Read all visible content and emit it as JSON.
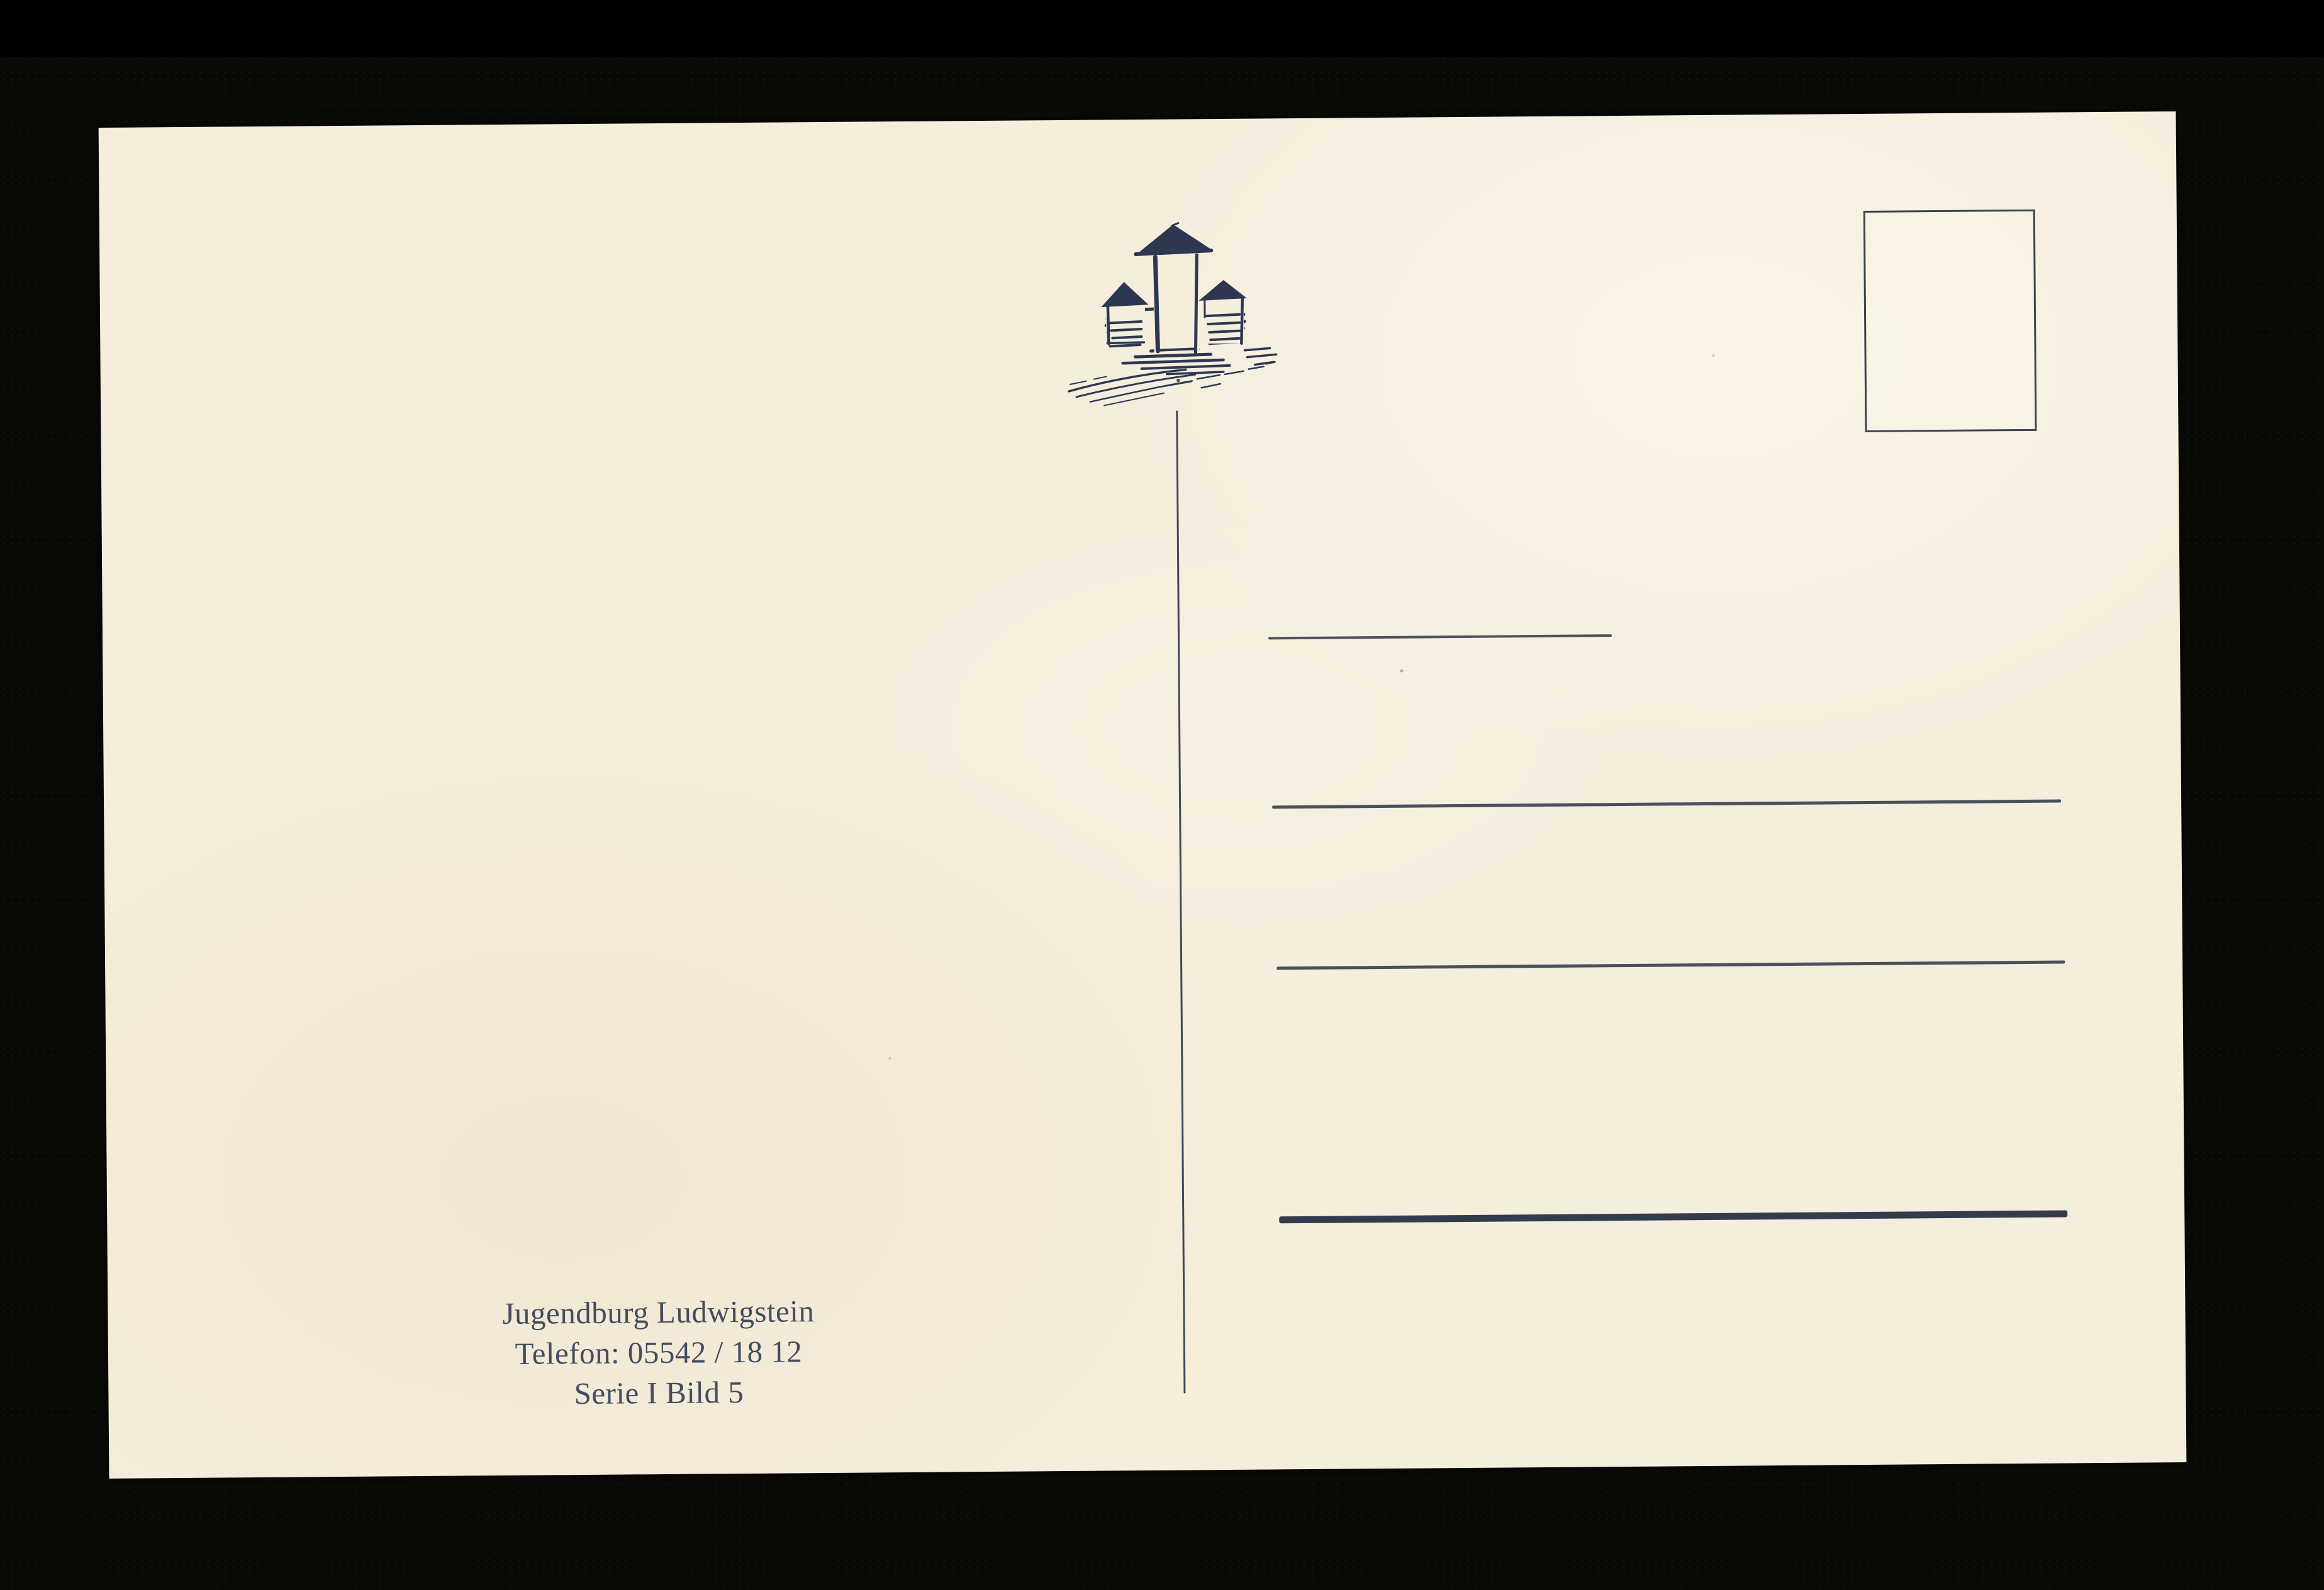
{
  "scan": {
    "background_color": "#0a0a07",
    "paper_color": "#f5eedd",
    "ink_color": "#2d3850"
  },
  "postcard": {
    "logo": {
      "icon": "castle-sketch-logo",
      "description": "hand-drawn castle with tall central tower and two side towers on a hatched hill"
    },
    "stamp_area": {
      "icon": "empty-stamp-frame"
    },
    "address_area": {
      "ruled_lines": 4
    },
    "publisher": {
      "name": "Jugendburg Ludwigstein",
      "phone": "Telefon: 05542 / 18 12",
      "series": "Serie I Bild 5"
    }
  }
}
